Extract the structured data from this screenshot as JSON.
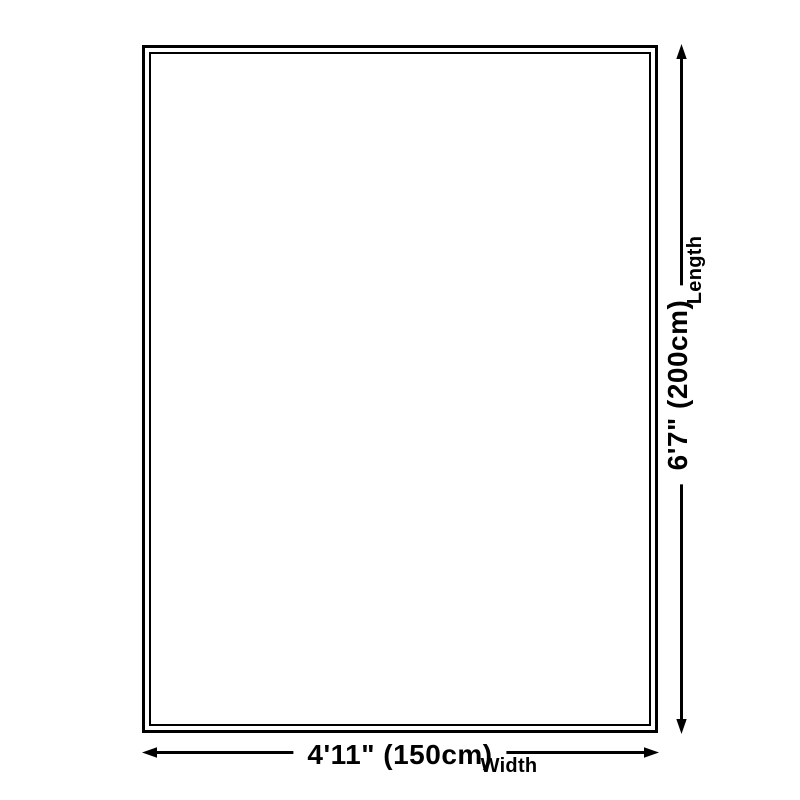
{
  "diagram": {
    "type": "product-dimensions",
    "background_color": "#ffffff",
    "line_color": "#000000",
    "dimensions": {
      "length": {
        "value": "6'7\" (200cm)",
        "label": "Length"
      },
      "width": {
        "value": "4'11\" (150cm)",
        "label": "Width"
      }
    }
  }
}
